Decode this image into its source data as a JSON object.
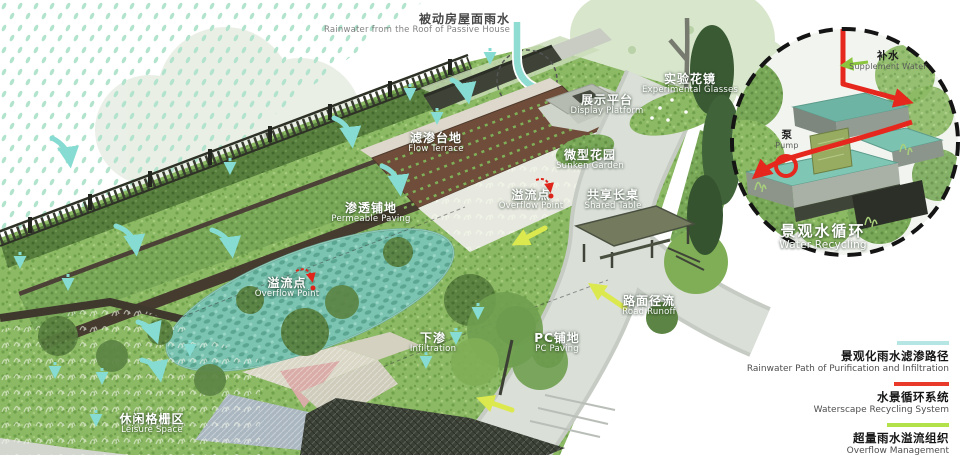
{
  "labels": {
    "roof_rainwater": {
      "cn": "被动房屋面雨水",
      "en": "Rainwater from the Roof of Passive House"
    },
    "flow_terrace": {
      "cn": "滤渗台地",
      "en": "Flow Terrace"
    },
    "permeable_paving": {
      "cn": "渗透铺地",
      "en": "Permeable Paving"
    },
    "overflow_point_pond": {
      "cn": "溢流点",
      "en": "Overflow Point"
    },
    "infiltration": {
      "cn": "下渗",
      "en": "Infiltration"
    },
    "pc_paving": {
      "cn": "PC铺地",
      "en": "PC Paving"
    },
    "leisure_space": {
      "cn": "休闲格栅区",
      "en": "Leisure Space"
    },
    "display_platform": {
      "cn": "展示平台",
      "en": "Display Platform"
    },
    "experimental_border": {
      "cn": "实验花镜",
      "en": "Experimental Glasses"
    },
    "sunken_garden": {
      "cn": "微型花园",
      "en": "Sunken Garden"
    },
    "overflow_point_2": {
      "cn": "溢流点",
      "en": "Overflow Point"
    },
    "shared_table": {
      "cn": "共享长桌",
      "en": "Shared Table"
    },
    "road_runoff": {
      "cn": "路面径流",
      "en": "Road Runoff"
    },
    "supplement_water": {
      "cn": "补水",
      "en": "Supplement Water"
    },
    "pump": {
      "cn": "泵",
      "en": "Pump"
    },
    "water_recycling": {
      "cn": "景观水循环",
      "en": "Water Recycling"
    }
  },
  "legend": {
    "items": [
      {
        "cn": "景观化雨水滤渗路径",
        "en": "Rainwater Path of Purification and Infiltration",
        "color": "#b5e6e3"
      },
      {
        "cn": "水景循环系统",
        "en": "Waterscape Recycling System",
        "color": "#e8392a"
      },
      {
        "cn": "超量雨水溢流组织",
        "en": "Overflow Management",
        "color": "#b2e14a"
      }
    ]
  },
  "colors": {
    "rain_drops": "#b2e3cd",
    "infiltration_arrow": "#86dcd2",
    "recycle_arrow": "#e5271d",
    "overflow_arrow": "#dce94e",
    "supplement_arrow": "#8cc63f",
    "pond_water": "#7cc4b2"
  }
}
